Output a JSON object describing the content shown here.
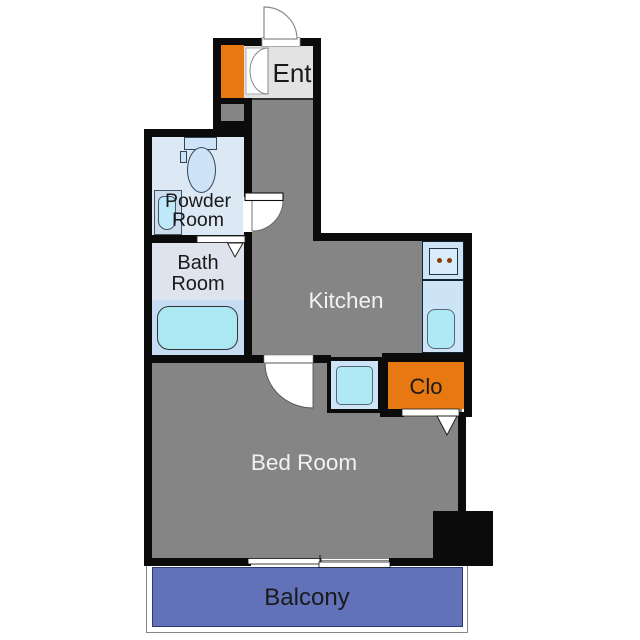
{
  "figure_type": "apartment-floor-plan",
  "rooms": {
    "ent": {
      "label": "Ent"
    },
    "powder_room": {
      "line1": "Powder",
      "line2": "Room"
    },
    "bath_room": {
      "line1": "Bath",
      "line2": "Room"
    },
    "kitchen": {
      "label": "Kitchen"
    },
    "closet": {
      "label": "Clo"
    },
    "bed_room": {
      "label": "Bed Room"
    },
    "balcony": {
      "label": "Balcony"
    }
  },
  "colors": {
    "wall": "#0b0b0b",
    "floor_gray": "#858585",
    "ent_floor": "#e3e3e3",
    "powder_floor": "#dce8f4",
    "bath_floor_upper": "#dfe3ed",
    "bath_floor_lower": "#c6dcf3",
    "fixture_blue": "#cde3f6",
    "water_cyan": "#aee9f5",
    "accent_orange": "#e87912",
    "balcony_blue": "#6272b8",
    "balcony_border": "#2c3a78"
  },
  "fixtures": [
    "shoe-cabinet",
    "toilet",
    "powder-sink",
    "bathtub",
    "kitchen-counter",
    "stove",
    "kitchen-sink",
    "washing-machine-pan",
    "closet",
    "pillar"
  ]
}
